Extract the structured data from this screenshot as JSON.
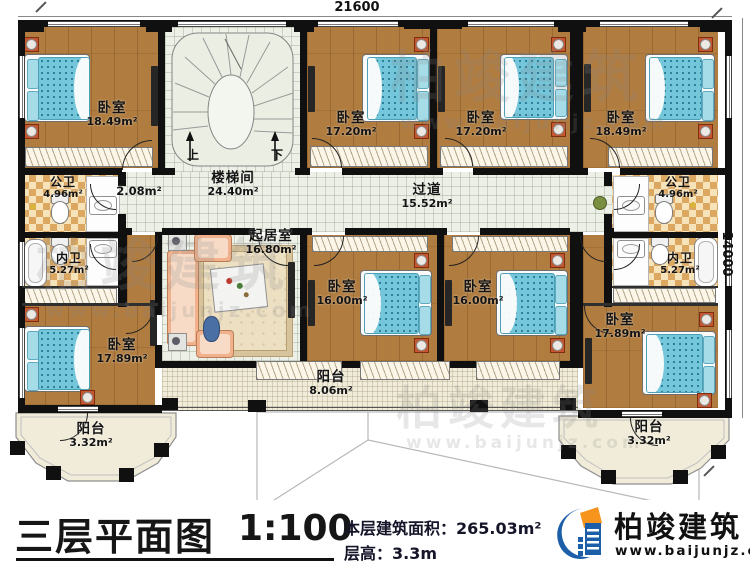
{
  "dimensions": {
    "top": "21600",
    "right": "14000"
  },
  "stair": {
    "up": "上",
    "down": "下"
  },
  "rooms": {
    "bedroom_tl": {
      "label": "卧室",
      "area": "18.49m²"
    },
    "stairwell": {
      "label": "楼梯间",
      "area": "24.40m²"
    },
    "bedroom_tm1": {
      "label": "卧室",
      "area": "17.20m²"
    },
    "bedroom_tm2": {
      "label": "卧室",
      "area": "17.20m²"
    },
    "bedroom_tr": {
      "label": "卧室",
      "area": "18.49m²"
    },
    "bath_public_left": {
      "label": "公卫",
      "area": "4.96m²"
    },
    "closet": {
      "area": "2.08m²"
    },
    "bath_private_left": {
      "label": "内卫",
      "area": "5.27m²"
    },
    "corridor": {
      "label": "过道",
      "area": "15.52m²"
    },
    "living_room": {
      "label": "起居室",
      "area": "16.80m²"
    },
    "bedroom_bl": {
      "label": "卧室",
      "area": "17.89m²"
    },
    "bedroom_bm1": {
      "label": "卧室",
      "area": "16.00m²"
    },
    "bedroom_bm2": {
      "label": "卧室",
      "area": "16.00m²"
    },
    "bath_public_right": {
      "label": "公卫",
      "area": "4.96m²"
    },
    "bath_private_right": {
      "label": "内卫",
      "area": "5.27m²"
    },
    "bedroom_br": {
      "label": "卧室",
      "area": "17.89m²"
    },
    "balcony_left": {
      "label": "阳台",
      "area": "3.32m²"
    },
    "balcony_center": {
      "label": "阳台",
      "area": "8.06m²"
    },
    "balcony_right": {
      "label": "阳台",
      "area": "3.32m²"
    }
  },
  "title_block": {
    "title": "三层平面图",
    "scale": "1:100",
    "area_label": "本层建筑面积：",
    "area_value": "265.03m²",
    "floor_height_label": "层高：",
    "floor_height_value": "3.3m"
  },
  "logo": {
    "name": "柏竣建筑",
    "url": "www.baijunjz.com"
  },
  "watermark": {
    "brand": "柏竣建筑",
    "url": "www.baijunjz.com"
  },
  "colors": {
    "wall": "#111111",
    "wood_floor": "#b07c3f",
    "tile_floor": "#edf0e7",
    "bath_tile": "#e3b974",
    "balcony_floor": "#f1ecd9",
    "mattress": "#74c6da",
    "sofa": "#f0b18c",
    "logo_blue": "#1c5fa8",
    "logo_orange": "#f7941d"
  }
}
